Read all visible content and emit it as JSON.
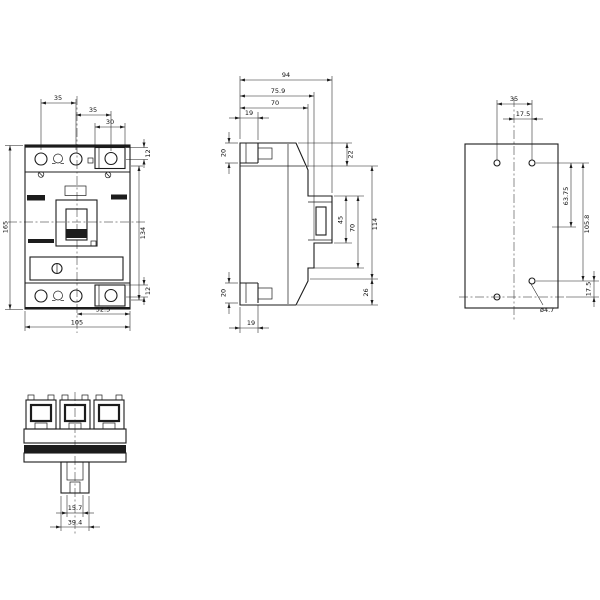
{
  "drawing": {
    "type": "technical-dimension-drawing",
    "views": {
      "front": {
        "name": "front view",
        "dims": {
          "pole_pitch_1": "35",
          "pole_pitch_2": "35",
          "terminal_width": "30",
          "terminal_top": "12",
          "height": "165",
          "height_inner": "134",
          "half_width": "52.5",
          "width": "105",
          "terminal_bottom": "12"
        }
      },
      "side": {
        "name": "side view",
        "dims": {
          "depth": "94",
          "depth_cover": "75.9",
          "depth_case": "70",
          "foot_top": "19",
          "bracket_top": "20",
          "bracket_bottom": "20",
          "foot_bottom": "19",
          "top_edge": "22",
          "handle_window": "45",
          "front_panel": "70",
          "case_height": "114",
          "bottom_edge": "26"
        }
      },
      "mounting": {
        "name": "drilling pattern",
        "dims": {
          "hole_pitch_h": "35",
          "hole_half_pitch": "17.5",
          "hole_pitch_v1": "63.75",
          "hole_pitch_v2": "105.8",
          "hole_offset_bottom": "17.5",
          "hole_diameter": "ø4.7"
        }
      },
      "bottom": {
        "name": "bottom view",
        "dims": {
          "slot_width": "15.7",
          "base_width": "39.4"
        }
      }
    }
  }
}
